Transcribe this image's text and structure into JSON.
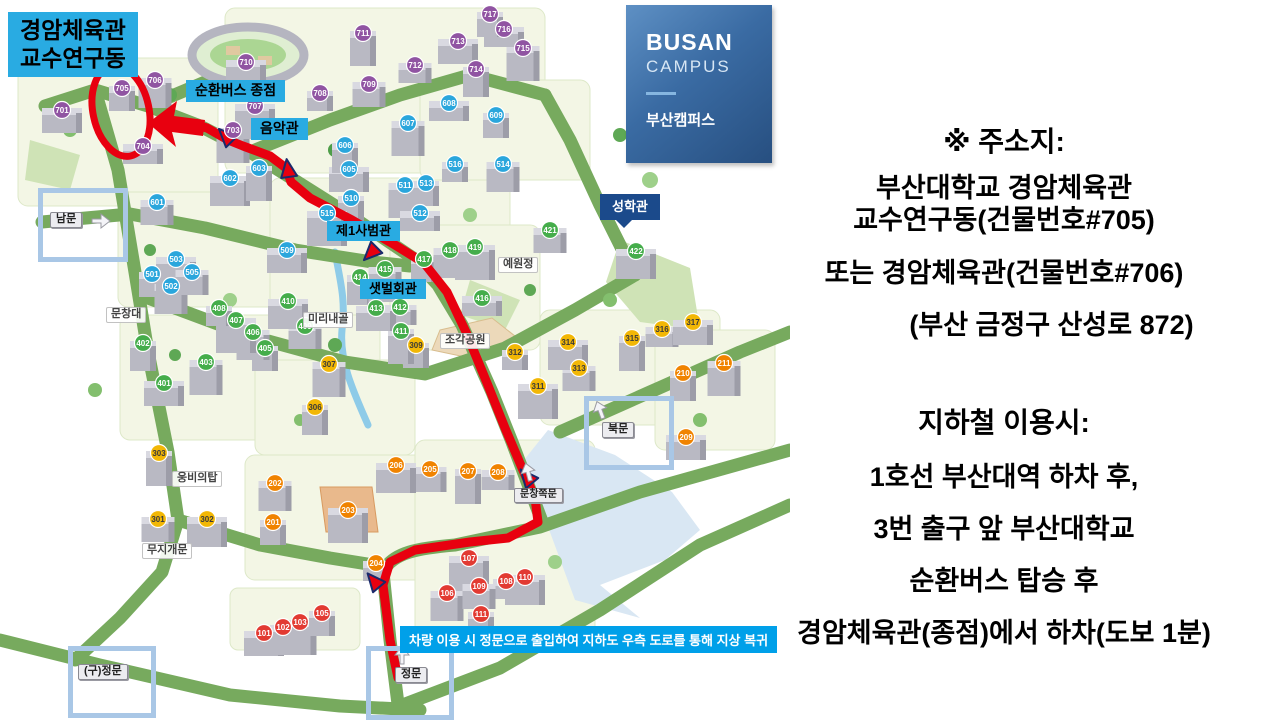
{
  "callout": {
    "line1": "경암체육관",
    "line2": "교수연구동"
  },
  "logo": {
    "en1": "BUSAN",
    "en2": "CAMPUS",
    "ko": "부산캠퍼스"
  },
  "info": {
    "address_title": "※ 주소지:",
    "address_line1": "부산대학교 경암체육관",
    "address_line2": "교수연구동(건물번호#705)",
    "address_line3": "또는 경암체육관(건물번호#706)",
    "address_line4": "(부산 금정구 산성로 872)",
    "subway_title": "지하철 이용시:",
    "subway_line1": "1호선 부산대역 하차 후,",
    "subway_line2": "3번 출구 앞 부산대학교",
    "subway_line3": "순환버스 탑승 후",
    "subway_line4": "경암체육관(종점)에서 하차(도보 1분)"
  },
  "map": {
    "notice": "차량 이용 시 정문으로 출입하여 지하도 우측 도로를 통해 지상 복귀",
    "labels": [
      {
        "id": "shuttle-bus-terminus",
        "text": "순환버스 종점",
        "style": "cyan",
        "x": 186,
        "y": 80,
        "fs": 14
      },
      {
        "id": "music-hall",
        "text": "음악관",
        "style": "cyan",
        "x": 251,
        "y": 118,
        "fs": 14
      },
      {
        "id": "first-education-hall",
        "text": "제1사범관",
        "style": "cyan",
        "x": 327,
        "y": 221,
        "fs": 13
      },
      {
        "id": "saetbeol-hall",
        "text": "샛벌회관",
        "style": "cyan",
        "x": 360,
        "y": 279,
        "fs": 13
      },
      {
        "id": "seonghak-hall",
        "text": "성학관",
        "style": "navy",
        "x": 600,
        "y": 194,
        "fs": 13
      },
      {
        "id": "munchangdae",
        "text": "문창대",
        "style": "plain",
        "x": 106,
        "y": 307,
        "fs": 11
      },
      {
        "id": "mirinae-valley",
        "text": "미리내골",
        "style": "plain",
        "x": 303,
        "y": 312,
        "fs": 11
      },
      {
        "id": "sculpture-park",
        "text": "조각공원",
        "style": "plain",
        "x": 440,
        "y": 333,
        "fs": 11
      },
      {
        "id": "yewonjeong",
        "text": "예원정",
        "style": "plain",
        "x": 498,
        "y": 257,
        "fs": 11
      },
      {
        "id": "ungbi-tower",
        "text": "웅비의탑",
        "style": "plain",
        "x": 172,
        "y": 471,
        "fs": 11
      },
      {
        "id": "rainbow-gate",
        "text": "무지개문",
        "style": "plain",
        "x": 142,
        "y": 543,
        "fs": 11
      },
      {
        "id": "munchang-side-gate",
        "text": "문창쪽문",
        "style": "gatesign",
        "x": 514,
        "y": 488,
        "fs": 10
      },
      {
        "id": "south-gate",
        "text": "남문",
        "style": "gatesign",
        "x": 50,
        "y": 212,
        "fs": 11
      },
      {
        "id": "north-gate",
        "text": "북문",
        "style": "gatesign",
        "x": 602,
        "y": 422,
        "fs": 11
      },
      {
        "id": "main-gate",
        "text": "정문",
        "style": "gatesign",
        "x": 395,
        "y": 667,
        "fs": 11
      },
      {
        "id": "old-main-gate",
        "text": "(구)정문",
        "style": "gatesign",
        "x": 78,
        "y": 664,
        "fs": 11
      }
    ],
    "gate_frames": [
      {
        "id": "south-gate-frame",
        "x": 38,
        "y": 188,
        "w": 80,
        "h": 64
      },
      {
        "id": "north-gate-frame",
        "x": 584,
        "y": 396,
        "w": 80,
        "h": 64
      },
      {
        "id": "main-gate-frame",
        "x": 366,
        "y": 646,
        "w": 78,
        "h": 64
      },
      {
        "id": "old-main-gate-frame",
        "x": 68,
        "y": 646,
        "w": 78,
        "h": 62
      }
    ],
    "badges": [
      {
        "n": 101,
        "x": 264,
        "y": 633,
        "c": "r"
      },
      {
        "n": 102,
        "x": 283,
        "y": 627,
        "c": "r"
      },
      {
        "n": 103,
        "x": 300,
        "y": 622,
        "c": "r"
      },
      {
        "n": 105,
        "x": 322,
        "y": 613,
        "c": "r"
      },
      {
        "n": 106,
        "x": 447,
        "y": 593,
        "c": "r"
      },
      {
        "n": 107,
        "x": 469,
        "y": 558,
        "c": "r"
      },
      {
        "n": 108,
        "x": 506,
        "y": 581,
        "c": "r"
      },
      {
        "n": 109,
        "x": 479,
        "y": 586,
        "c": "r"
      },
      {
        "n": 110,
        "x": 525,
        "y": 577,
        "c": "r"
      },
      {
        "n": 111,
        "x": 481,
        "y": 614,
        "c": "r"
      },
      {
        "n": 201,
        "x": 273,
        "y": 522,
        "c": "o"
      },
      {
        "n": 202,
        "x": 275,
        "y": 483,
        "c": "o"
      },
      {
        "n": 203,
        "x": 348,
        "y": 510,
        "c": "o"
      },
      {
        "n": 204,
        "x": 376,
        "y": 563,
        "c": "o"
      },
      {
        "n": 205,
        "x": 430,
        "y": 469,
        "c": "o"
      },
      {
        "n": 206,
        "x": 396,
        "y": 465,
        "c": "o"
      },
      {
        "n": 207,
        "x": 468,
        "y": 471,
        "c": "o"
      },
      {
        "n": 208,
        "x": 498,
        "y": 472,
        "c": "o"
      },
      {
        "n": 209,
        "x": 686,
        "y": 437,
        "c": "o"
      },
      {
        "n": 210,
        "x": 683,
        "y": 373,
        "c": "o"
      },
      {
        "n": 211,
        "x": 724,
        "y": 363,
        "c": "o"
      },
      {
        "n": 301,
        "x": 158,
        "y": 519,
        "c": "y"
      },
      {
        "n": 302,
        "x": 207,
        "y": 519,
        "c": "y"
      },
      {
        "n": 303,
        "x": 159,
        "y": 453,
        "c": "y"
      },
      {
        "n": 306,
        "x": 315,
        "y": 407,
        "c": "y"
      },
      {
        "n": 307,
        "x": 329,
        "y": 364,
        "c": "y"
      },
      {
        "n": 309,
        "x": 416,
        "y": 345,
        "c": "y"
      },
      {
        "n": 311,
        "x": 538,
        "y": 386,
        "c": "y"
      },
      {
        "n": 312,
        "x": 515,
        "y": 352,
        "c": "y"
      },
      {
        "n": 313,
        "x": 579,
        "y": 368,
        "c": "y"
      },
      {
        "n": 314,
        "x": 568,
        "y": 342,
        "c": "y"
      },
      {
        "n": 315,
        "x": 632,
        "y": 338,
        "c": "y"
      },
      {
        "n": 316,
        "x": 662,
        "y": 329,
        "c": "y"
      },
      {
        "n": 317,
        "x": 693,
        "y": 322,
        "c": "y"
      },
      {
        "n": 401,
        "x": 164,
        "y": 383,
        "c": "g"
      },
      {
        "n": 402,
        "x": 143,
        "y": 343,
        "c": "g"
      },
      {
        "n": 403,
        "x": 206,
        "y": 362,
        "c": "g"
      },
      {
        "n": 405,
        "x": 265,
        "y": 348,
        "c": "g"
      },
      {
        "n": 406,
        "x": 253,
        "y": 332,
        "c": "g"
      },
      {
        "n": 407,
        "x": 236,
        "y": 320,
        "c": "g"
      },
      {
        "n": 408,
        "x": 219,
        "y": 308,
        "c": "g"
      },
      {
        "n": 409,
        "x": 305,
        "y": 326,
        "c": "g"
      },
      {
        "n": 410,
        "x": 288,
        "y": 301,
        "c": "g"
      },
      {
        "n": 411,
        "x": 401,
        "y": 331,
        "c": "g"
      },
      {
        "n": 412,
        "x": 400,
        "y": 307,
        "c": "g"
      },
      {
        "n": 413,
        "x": 376,
        "y": 308,
        "c": "g"
      },
      {
        "n": 414,
        "x": 360,
        "y": 277,
        "c": "g"
      },
      {
        "n": 415,
        "x": 385,
        "y": 269,
        "c": "g"
      },
      {
        "n": 416,
        "x": 482,
        "y": 298,
        "c": "g"
      },
      {
        "n": 417,
        "x": 424,
        "y": 259,
        "c": "g"
      },
      {
        "n": 418,
        "x": 450,
        "y": 250,
        "c": "g"
      },
      {
        "n": 419,
        "x": 475,
        "y": 247,
        "c": "g"
      },
      {
        "n": 421,
        "x": 550,
        "y": 230,
        "c": "g"
      },
      {
        "n": 422,
        "x": 636,
        "y": 251,
        "c": "g"
      },
      {
        "n": 501,
        "x": 152,
        "y": 274,
        "c": "b"
      },
      {
        "n": 502,
        "x": 171,
        "y": 286,
        "c": "b"
      },
      {
        "n": 503,
        "x": 176,
        "y": 259,
        "c": "b"
      },
      {
        "n": 505,
        "x": 192,
        "y": 272,
        "c": "b"
      },
      {
        "n": 509,
        "x": 287,
        "y": 250,
        "c": "b"
      },
      {
        "n": 510,
        "x": 351,
        "y": 198,
        "c": "b"
      },
      {
        "n": 511,
        "x": 405,
        "y": 185,
        "c": "b"
      },
      {
        "n": 512,
        "x": 420,
        "y": 213,
        "c": "b"
      },
      {
        "n": 513,
        "x": 426,
        "y": 183,
        "c": "b"
      },
      {
        "n": 514,
        "x": 503,
        "y": 164,
        "c": "b"
      },
      {
        "n": 515,
        "x": 327,
        "y": 213,
        "c": "b"
      },
      {
        "n": 516,
        "x": 455,
        "y": 164,
        "c": "b"
      },
      {
        "n": 601,
        "x": 157,
        "y": 202,
        "c": "b"
      },
      {
        "n": 602,
        "x": 230,
        "y": 178,
        "c": "b"
      },
      {
        "n": 603,
        "x": 259,
        "y": 168,
        "c": "b"
      },
      {
        "n": 605,
        "x": 349,
        "y": 169,
        "c": "b"
      },
      {
        "n": 606,
        "x": 345,
        "y": 145,
        "c": "b"
      },
      {
        "n": 607,
        "x": 408,
        "y": 123,
        "c": "b"
      },
      {
        "n": 608,
        "x": 449,
        "y": 103,
        "c": "b"
      },
      {
        "n": 609,
        "x": 496,
        "y": 115,
        "c": "b"
      },
      {
        "n": 701,
        "x": 62,
        "y": 110,
        "c": "p"
      },
      {
        "n": 703,
        "x": 233,
        "y": 130,
        "c": "p"
      },
      {
        "n": 704,
        "x": 143,
        "y": 146,
        "c": "p"
      },
      {
        "n": 705,
        "x": 122,
        "y": 88,
        "c": "p"
      },
      {
        "n": 706,
        "x": 155,
        "y": 80,
        "c": "p"
      },
      {
        "n": 707,
        "x": 255,
        "y": 106,
        "c": "p"
      },
      {
        "n": 708,
        "x": 320,
        "y": 93,
        "c": "p"
      },
      {
        "n": 709,
        "x": 369,
        "y": 84,
        "c": "p"
      },
      {
        "n": 710,
        "x": 246,
        "y": 62,
        "c": "p"
      },
      {
        "n": 711,
        "x": 363,
        "y": 33,
        "c": "p"
      },
      {
        "n": 712,
        "x": 415,
        "y": 65,
        "c": "p"
      },
      {
        "n": 713,
        "x": 458,
        "y": 41,
        "c": "p"
      },
      {
        "n": 714,
        "x": 476,
        "y": 69,
        "c": "p"
      },
      {
        "n": 715,
        "x": 523,
        "y": 48,
        "c": "p"
      },
      {
        "n": 716,
        "x": 504,
        "y": 29,
        "c": "p"
      },
      {
        "n": 717,
        "x": 490,
        "y": 14,
        "c": "p"
      }
    ]
  },
  "colors": {
    "route": "#e8000f",
    "callout_bg": "#29abe2",
    "notice_bg": "#00a0e9",
    "navy_label": "#1b4a8b",
    "badge_100s": "#e23a32",
    "badge_200s": "#f08300",
    "badge_300s": "#f2b705",
    "badge_400s": "#45ad4b",
    "badge_500s_600s": "#2aa6dc",
    "badge_700s": "#9054a2",
    "road_green": "#77aa5e"
  }
}
